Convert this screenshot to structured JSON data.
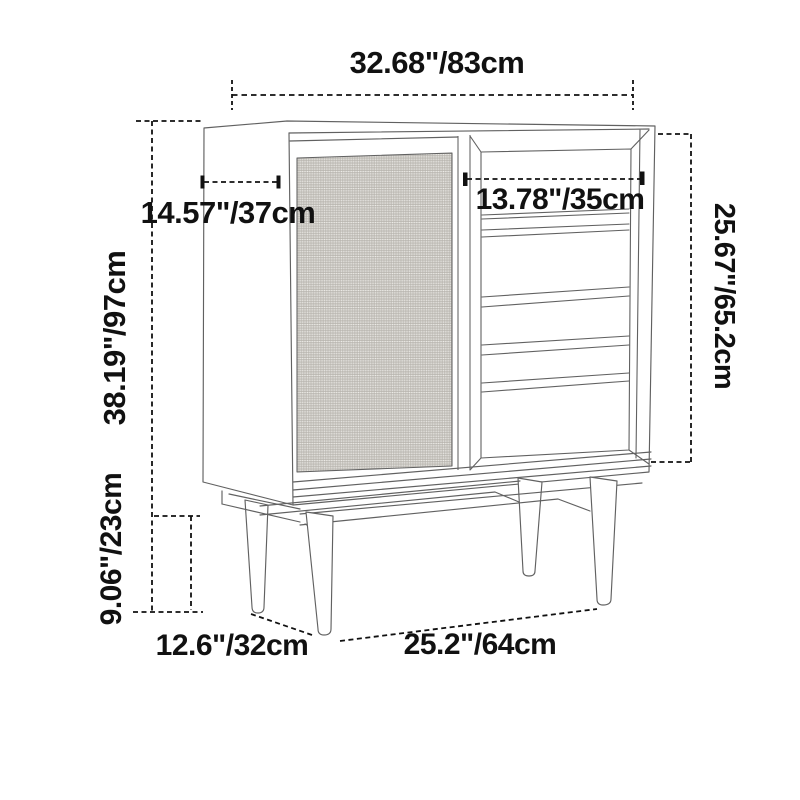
{
  "page": {
    "background_color": "#ffffff",
    "drawing_line_color": "#616161",
    "dimension_color": "#111111"
  },
  "diagram": {
    "subject": "cabinet-dimension-diagram",
    "dimensions": {
      "overall_width": "32.68\"/83cm",
      "side_depth": "14.57\"/37cm",
      "compartment_width": "13.78\"/35cm",
      "overall_height": "38.19\"/97cm",
      "door_height": "25.67\"/65.2cm",
      "leg_height": "9.06\"/23cm",
      "leg_depth_spacing": "12.6\"/32cm",
      "leg_width_spacing": "25.2\"/64cm"
    }
  }
}
